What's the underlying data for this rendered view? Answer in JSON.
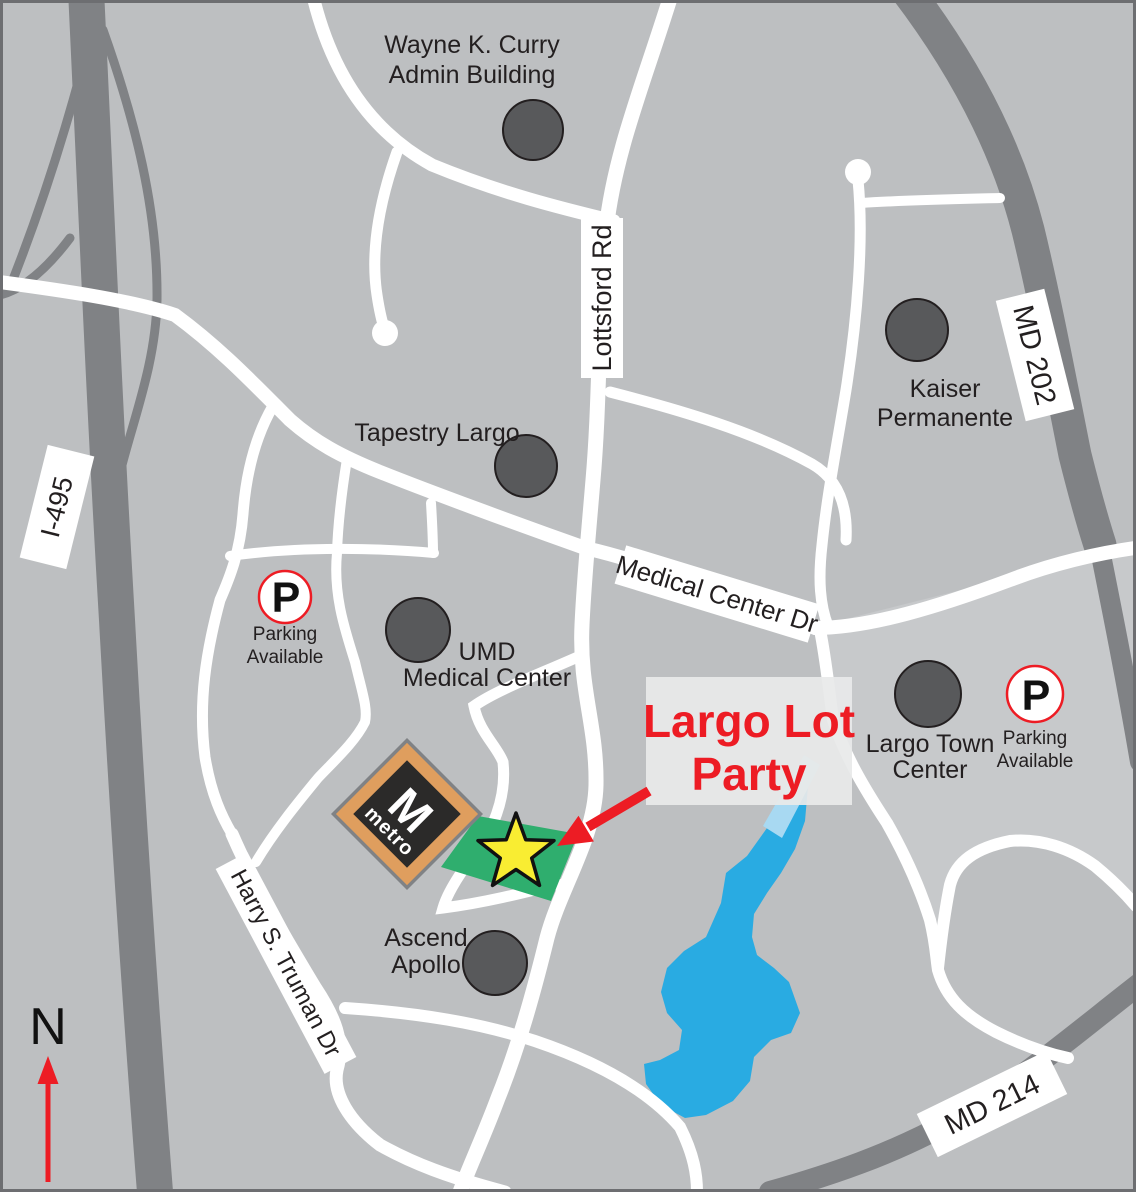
{
  "colors": {
    "background": "#BDBFC1",
    "district_light": "#C7C9CB",
    "road_major": "#808285",
    "road_minor": "#FFFFFF",
    "poi_circle": "#58595B",
    "lake": "#29ABE2",
    "stream": "#A8D9F2",
    "lot_green": "#2FAE6E",
    "star_yellow": "#F9ED32",
    "accent_red": "#ED1C24",
    "metro_orange": "#DF9E5E",
    "metro_black": "#2B2A29"
  },
  "roads": {
    "i495": "I-495",
    "md202": "MD 202",
    "md214": "MD 214",
    "lottsford": "Lottsford Rd",
    "medical_center": "Medical Center Dr",
    "truman": "Harry S. Truman Dr"
  },
  "pois": {
    "wayne_curry": {
      "line1": "Wayne K. Curry",
      "line2": "Admin Building"
    },
    "tapestry": {
      "line1": "Tapestry Largo"
    },
    "kaiser": {
      "line1": "Kaiser",
      "line2": "Permanente"
    },
    "umd": {
      "line1": "UMD",
      "line2": "Medical Center"
    },
    "largo_town": {
      "line1": "Largo Town",
      "line2": "Center"
    },
    "ascend": {
      "line1": "Ascend",
      "line2": "Apollo"
    }
  },
  "parking": {
    "symbol": "P",
    "line1": "Parking",
    "line2": "Available"
  },
  "callout": {
    "line1": "Largo Lot",
    "line2": "Party"
  },
  "metro": {
    "initial": "M",
    "wordmark": "metro"
  },
  "compass": {
    "label": "N"
  }
}
